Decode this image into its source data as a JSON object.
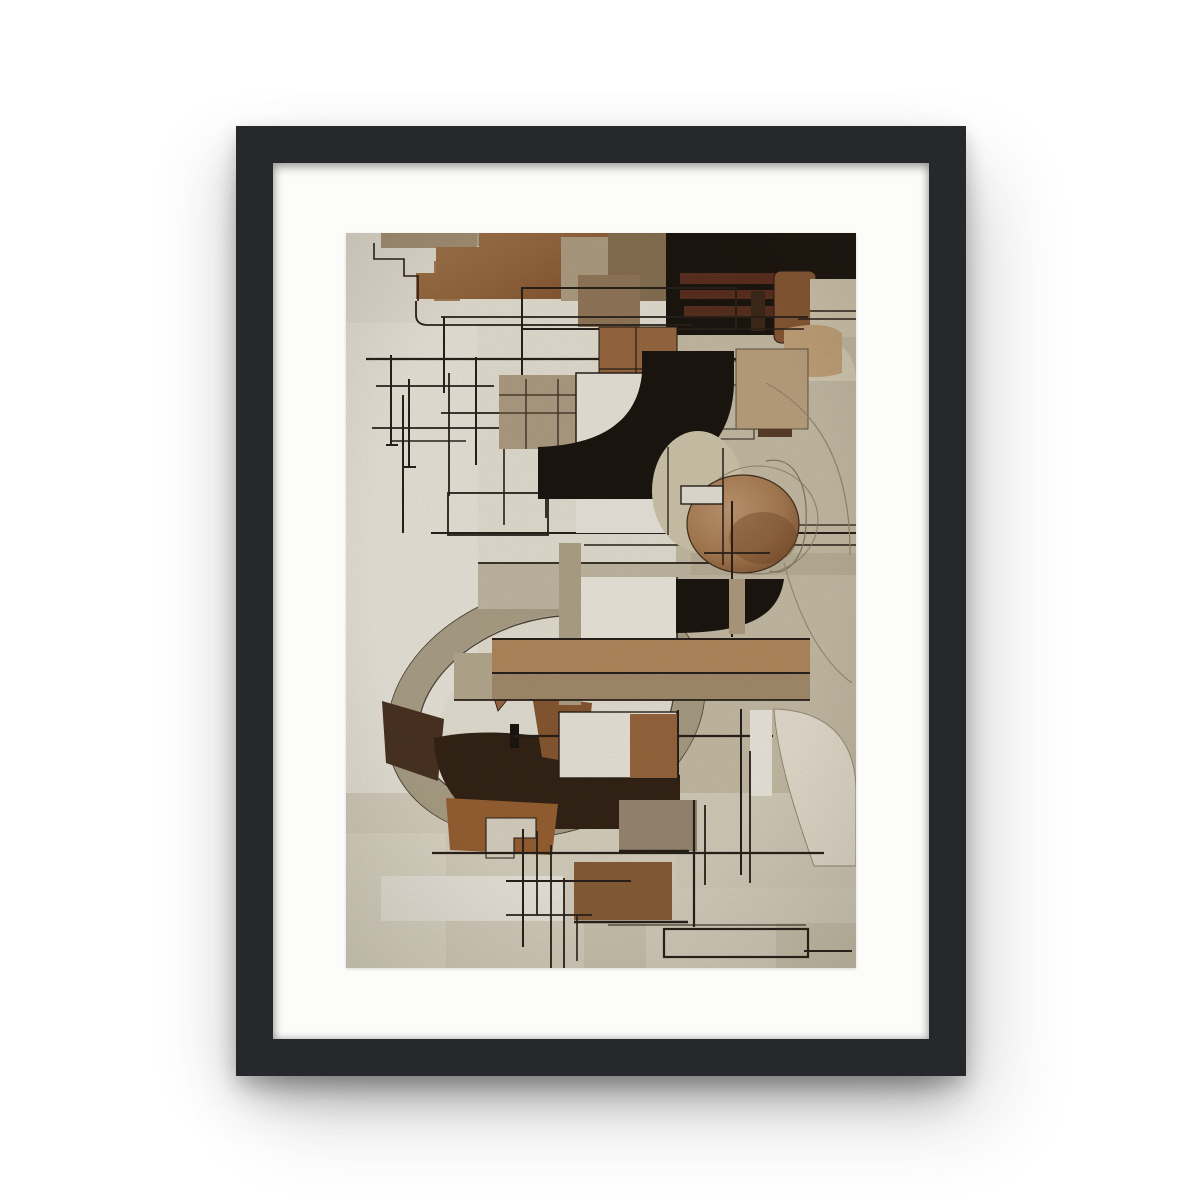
{
  "scene": {
    "type": "product-photo-framed-poster",
    "background": "#ffffff"
  },
  "artwork": {
    "description": "Abstract cubist-style geometric collage in browns, beiges, black and off-white with thin black line grids, arcs, circles and fan shapes",
    "orientation": "portrait"
  },
  "colors": {
    "bg": "#ffffff",
    "frame": "#26282b",
    "mat": "#fcfcfa",
    "base": "#e8e3d5",
    "baseLight": "#edeadf",
    "tanRight": "#c5bca4",
    "bottomBand": "#d9d2c0",
    "line": "#2a211a",
    "black": "#1d1610",
    "brown": "#9b6a42",
    "brownDeep": "#8a5a36",
    "rust": "#9a6233",
    "umber": "#8a5a33",
    "chocolate": "#352417",
    "darkBrown": "#4b3322",
    "tanGrid": "#b2a085",
    "beige": "#d5cab1",
    "cream": "#efeae0",
    "ringBand": "#ab9f85",
    "circleLight": "#c49b74",
    "circleDark": "#7e5130",
    "barBrown": "#b48b5f",
    "barTan": "#a68f6e"
  }
}
